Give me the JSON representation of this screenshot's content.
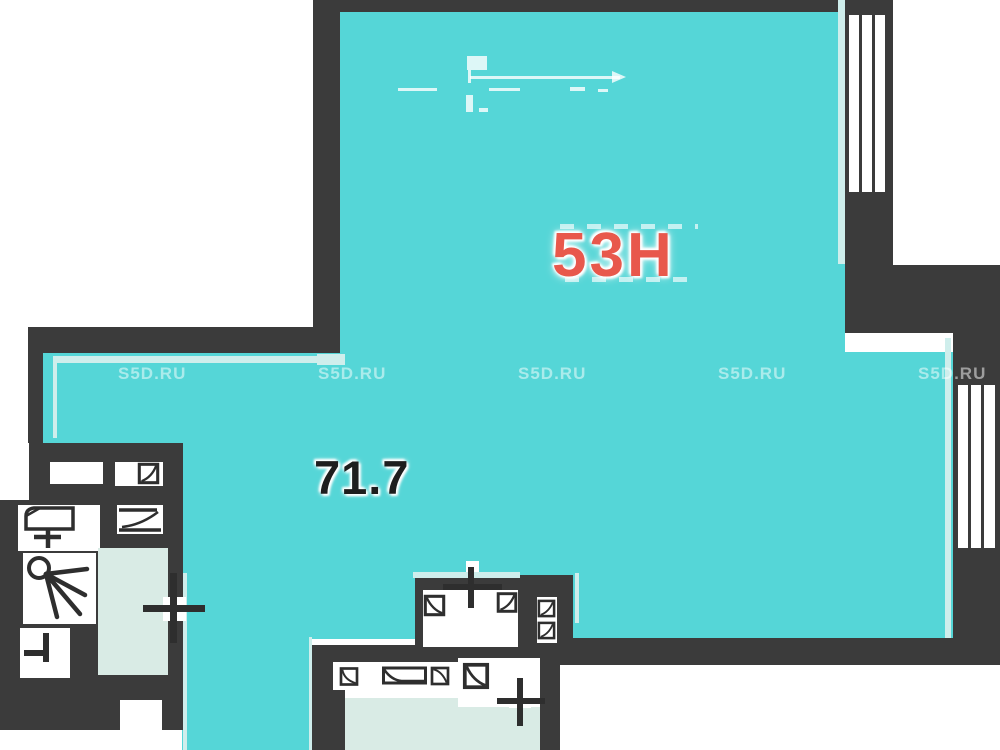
{
  "plan": {
    "unit_label": "53Н",
    "area_label": "71.7",
    "watermark": "S5D.RU",
    "colors": {
      "background": "#ffffff",
      "room_fill": "#55d6d7",
      "room_fill_light": "#cfeeec",
      "secondary_fill": "#d9ebe5",
      "wall": "#3b3b3b",
      "fixture_stroke": "#2e2e2e",
      "unit_label_color": "#e8584c",
      "area_label_color": "#1e1e1e",
      "watermark_color": "rgba(255,255,255,0.5)"
    }
  }
}
